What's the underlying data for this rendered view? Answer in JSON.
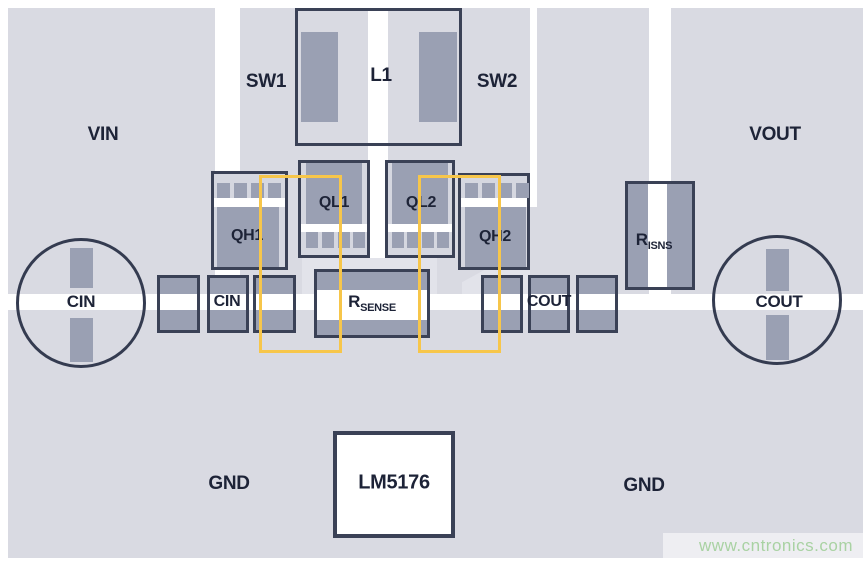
{
  "diagram": {
    "title": "LM5176 buck-boost converter PCB layout",
    "region_labels": {
      "vin": "VIN",
      "sw1": "SW1",
      "l1": "L1",
      "sw2": "SW2",
      "vout": "VOUT",
      "gnd_left": "GND",
      "gnd_right": "GND"
    },
    "components": {
      "qh1": "QH1",
      "ql1": "QL1",
      "ql2": "QL2",
      "qh2": "QH2",
      "cin_bulk": "CIN",
      "cin": "CIN",
      "cout": "COUT",
      "cout_bulk": "COUT",
      "rsense": {
        "main": "R",
        "sub": "SENSE"
      },
      "risns": {
        "main": "R",
        "sub": "ISNS"
      },
      "ic": "LM5176"
    },
    "watermark": {
      "text": "www.cntronics.com"
    },
    "colors": {
      "copper_pour": "#d9dae2",
      "copper_pour_light": "#e2e3ea",
      "pad_gray": "#9aa0b3",
      "outline_navy": "#3a4156",
      "label_text": "#1d2337",
      "loop_highlight_yellow": "#f7c64a",
      "watermark_green": "#a9d2a3",
      "background": "#ffffff"
    }
  }
}
